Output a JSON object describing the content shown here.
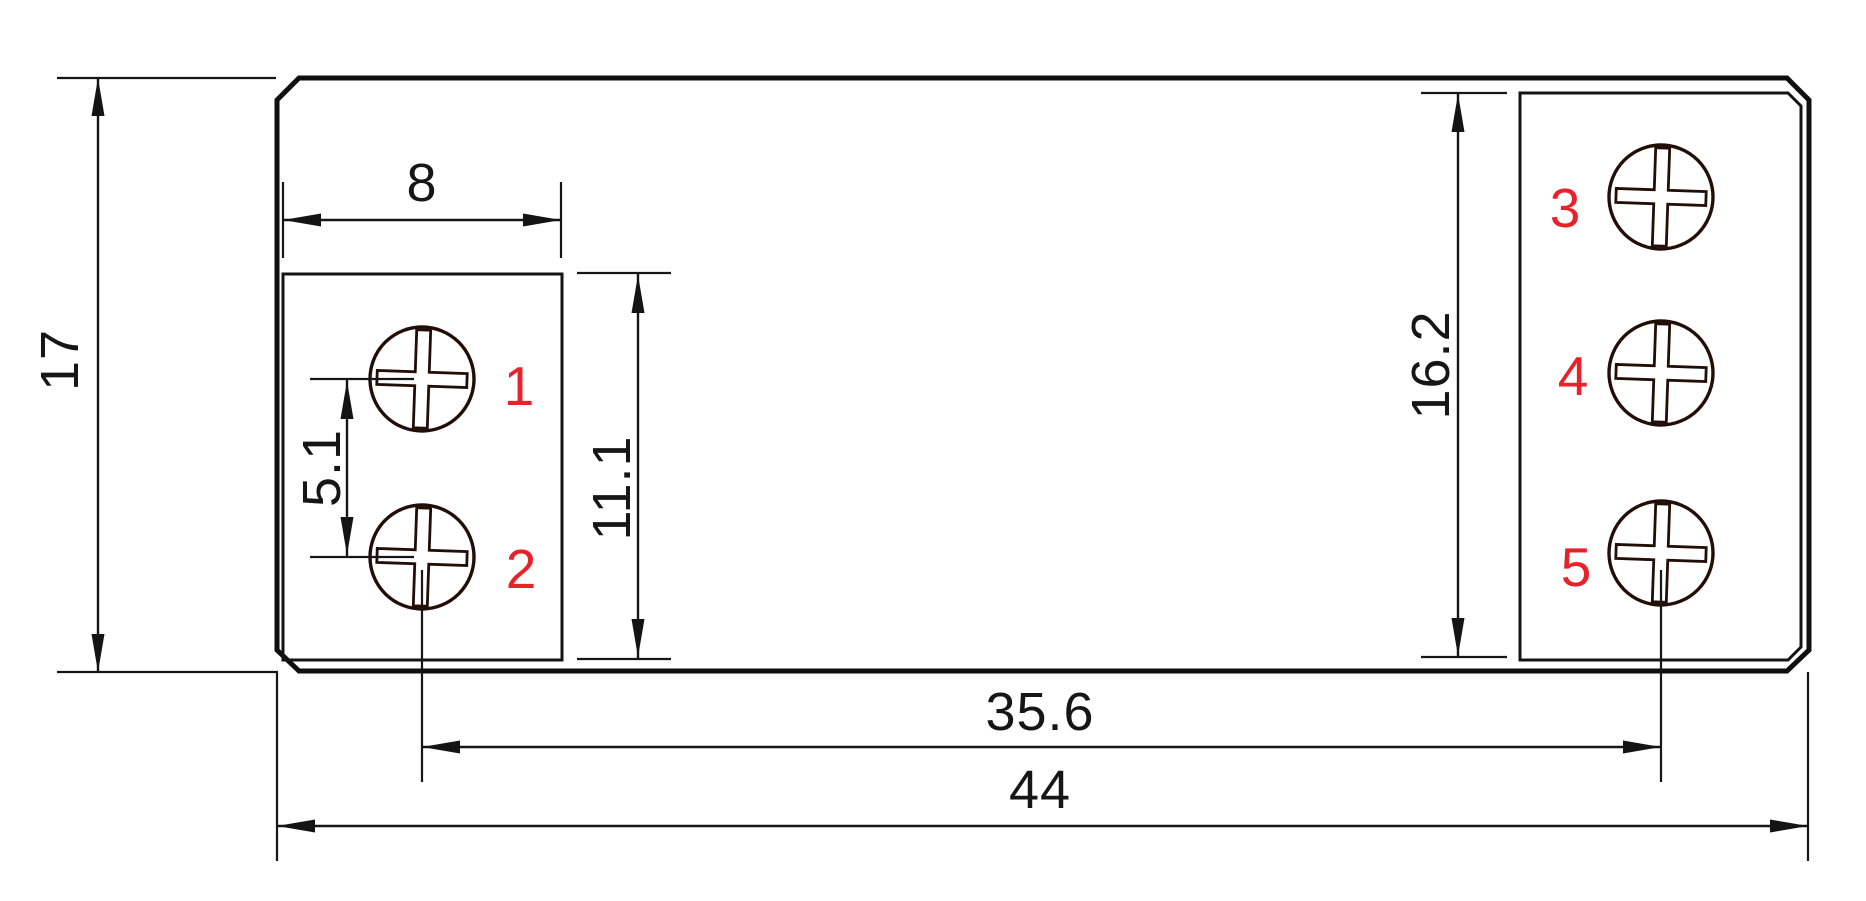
{
  "dimensions": {
    "overall_height": "17",
    "overall_width": "44",
    "left_terminal_width": "8",
    "left_screw_pitch": "5.1",
    "left_terminal_height": "11.1",
    "right_terminal_height": "16.2",
    "screw_columns_span": "35.6"
  },
  "terminal_labels": [
    "1",
    "2",
    "3",
    "4",
    "5"
  ],
  "colors": {
    "line": "#141414",
    "screw_line": "#230e07",
    "terminal_number_red": "#e8222a",
    "background": "#ffffff"
  }
}
